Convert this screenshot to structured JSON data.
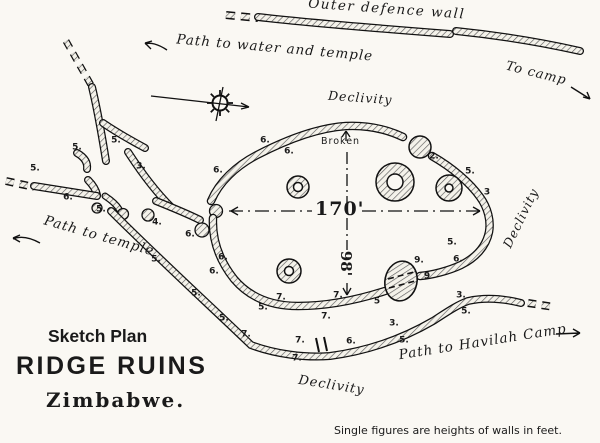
{
  "title_block": {
    "line1": "Sketch Plan",
    "line2": "RIDGE RUINS",
    "line3": "Zimbabwe."
  },
  "map_labels": {
    "outer_defence_wall": "Outer defence wall",
    "path_to_water": "Path to water and temple",
    "to_camp": "To camp",
    "declivity_top": "Declivity",
    "declivity_right": "Declivity",
    "declivity_bottom": "Declivity",
    "broken": "Broken",
    "path_to_temple": "Path to temple",
    "path_to_havilah": "Path to Havilah Camp"
  },
  "dimensions": {
    "width": "170'",
    "height": "98'"
  },
  "footnote": "Single figures are heights of walls in feet.",
  "wall_height_labels": [
    {
      "v": "5.",
      "x": 35,
      "y": 169
    },
    {
      "v": "6.",
      "x": 68,
      "y": 198
    },
    {
      "v": "5.",
      "x": 77,
      "y": 148
    },
    {
      "v": "5.",
      "x": 116,
      "y": 141
    },
    {
      "v": "3.",
      "x": 141,
      "y": 167
    },
    {
      "v": "5.",
      "x": 101,
      "y": 210
    },
    {
      "v": "4.",
      "x": 157,
      "y": 223
    },
    {
      "v": "6.",
      "x": 218,
      "y": 171
    },
    {
      "v": "6.",
      "x": 190,
      "y": 235
    },
    {
      "v": "6.",
      "x": 223,
      "y": 258
    },
    {
      "v": "6.",
      "x": 214,
      "y": 272
    },
    {
      "v": "5.",
      "x": 156,
      "y": 260
    },
    {
      "v": "5.",
      "x": 196,
      "y": 294
    },
    {
      "v": "7.",
      "x": 281,
      "y": 298
    },
    {
      "v": "6.",
      "x": 265,
      "y": 141
    },
    {
      "v": "6.",
      "x": 289,
      "y": 152
    },
    {
      "v": "2.",
      "x": 434,
      "y": 157
    },
    {
      "v": "5.",
      "x": 470,
      "y": 172
    },
    {
      "v": "3",
      "x": 487,
      "y": 193
    },
    {
      "v": "5.",
      "x": 452,
      "y": 243
    },
    {
      "v": "6.",
      "x": 458,
      "y": 260
    },
    {
      "v": "9.",
      "x": 419,
      "y": 261
    },
    {
      "v": "9",
      "x": 427,
      "y": 277
    },
    {
      "v": "5",
      "x": 377,
      "y": 302
    },
    {
      "v": "5.",
      "x": 263,
      "y": 308
    },
    {
      "v": "7.",
      "x": 338,
      "y": 296
    },
    {
      "v": "7.",
      "x": 326,
      "y": 317
    },
    {
      "v": "3.",
      "x": 394,
      "y": 324
    },
    {
      "v": "5.",
      "x": 404,
      "y": 341
    },
    {
      "v": "5.",
      "x": 224,
      "y": 319
    },
    {
      "v": "7.",
      "x": 246,
      "y": 335
    },
    {
      "v": "7.",
      "x": 300,
      "y": 341
    },
    {
      "v": "7.",
      "x": 297,
      "y": 359
    },
    {
      "v": "6.",
      "x": 351,
      "y": 342
    },
    {
      "v": "3.",
      "x": 461,
      "y": 296
    },
    {
      "v": "5.",
      "x": 466,
      "y": 312
    }
  ],
  "colors": {
    "ink": "#1a1a1a",
    "paper": "#faf8f3",
    "hatch_line": "#5a5a5a"
  }
}
